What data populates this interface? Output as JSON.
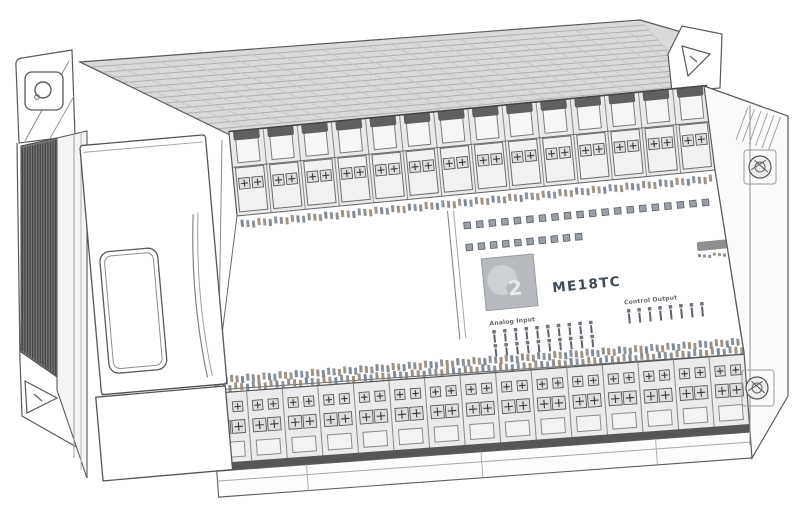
{
  "device": {
    "model": "ME18TC",
    "logo_digit": "2",
    "labels": {
      "input_group": "Analog Input",
      "output_group": "Control Output"
    }
  },
  "indicators": {
    "status_row1_count": 20,
    "status_row2_count": 10,
    "input_channels": 10,
    "output_channels": 8
  },
  "terminals": {
    "top_segments": 14,
    "bottom_segments": 15,
    "screws_per_segment": 2
  },
  "colors": {
    "line": "#5a5a5a",
    "panel_fill": "#ffffff",
    "strip_fill": "#eaeaea",
    "block_fill": "#f1f1f1",
    "screw_fill": "#dedede",
    "dark_cap": "#606060",
    "top_hatch_fill": "#d9d9d9",
    "top_hatch_line": "#b0b0b0",
    "vent_fill": "#787878",
    "vent_line": "#454545",
    "led_fill": "#9aa0a8",
    "led_edge": "#63676e",
    "logo_fill": "#b7bbc0",
    "logo_blob": "#cdd0d4",
    "logo_digit_color": "#e7e9ec",
    "model_text_color": "#3d4a59",
    "tiny_label_color": "#4a4a4a",
    "noise_palette": [
      "#77828f",
      "#8f8277",
      "#7c7c7c",
      "#697582",
      "#8f8068"
    ]
  }
}
